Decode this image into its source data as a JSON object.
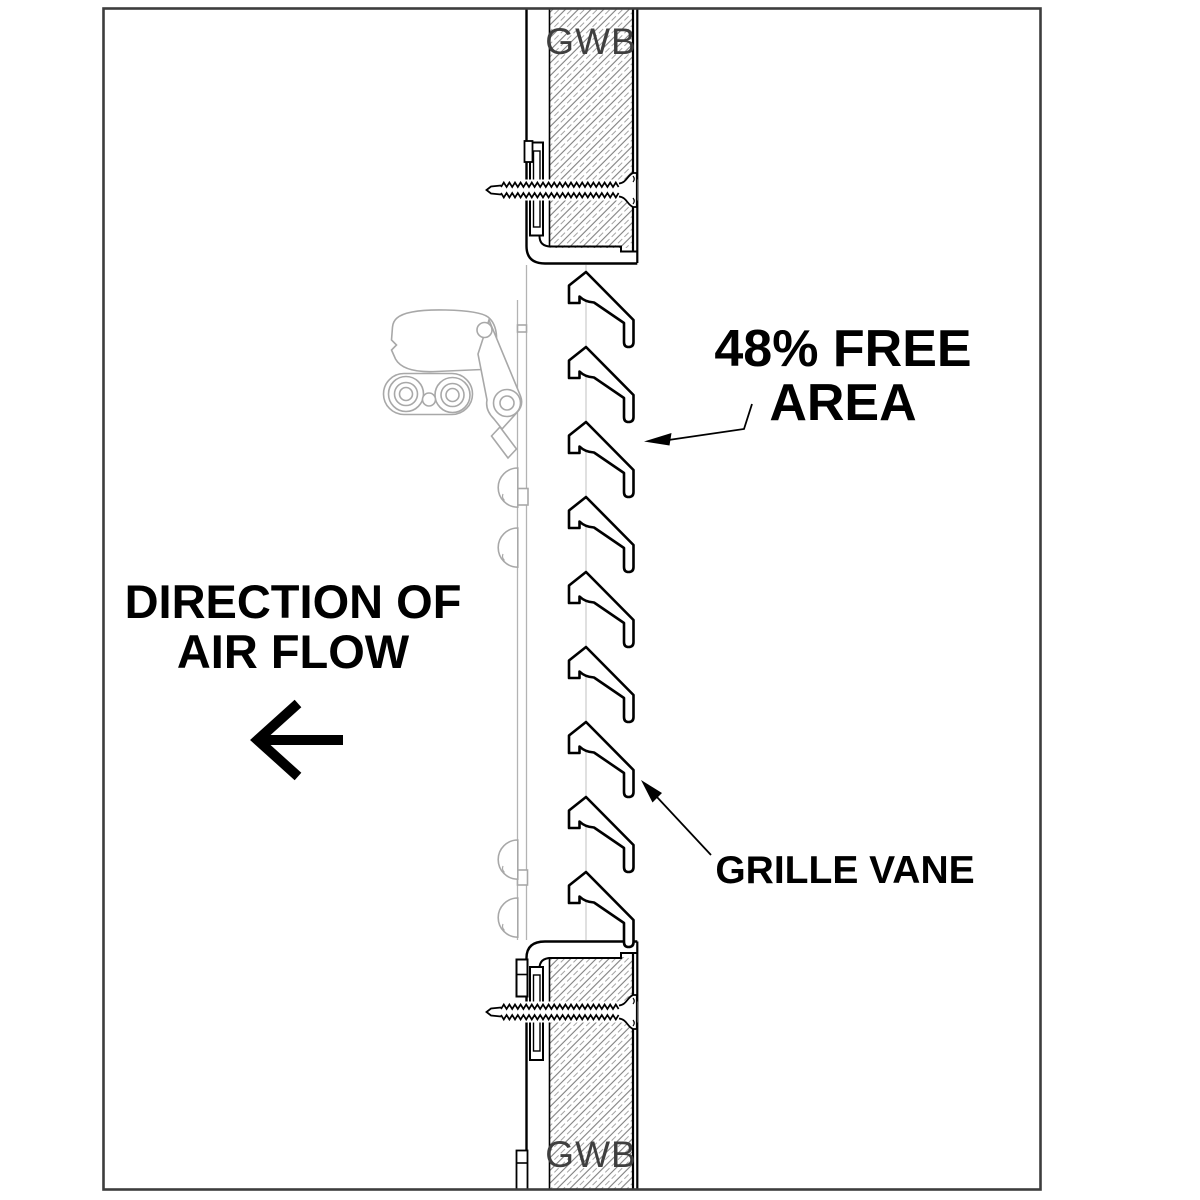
{
  "drawing": {
    "type": "architectural-section-detail",
    "subject": "door grille vane section in gypsum wall board",
    "labels": {
      "gwb_top": "GWB",
      "gwb_bottom": "GWB",
      "free_area_line1": "48% FREE",
      "free_area_line2": "AREA",
      "direction_line1": "DIRECTION OF",
      "direction_line2": "AIR FLOW",
      "grille_vane": "GRILLE VANE"
    },
    "values": {
      "free_area_percent": 48,
      "vane_count": 9,
      "air_flow_direction": "left"
    },
    "colors": {
      "line": "#000000",
      "border": "#3d3d3d",
      "hatch": "#7f7f7f",
      "hardware_gray": "#a8a8a8",
      "gwb_text": "#3f3f3f",
      "background": "#ffffff"
    }
  }
}
